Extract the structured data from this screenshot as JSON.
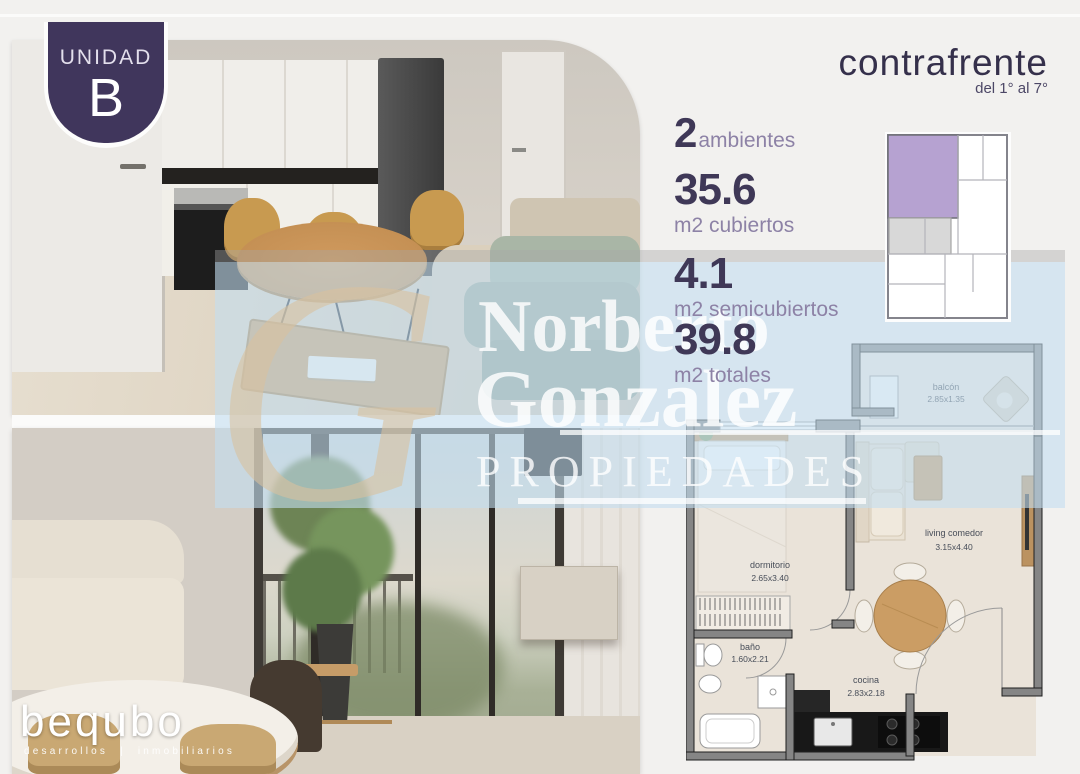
{
  "badge": {
    "line1": "UNIDAD",
    "line2": "B"
  },
  "header": {
    "title": "contrafrente",
    "subtitle": "del 1° al 7°"
  },
  "stats": [
    {
      "value": "2",
      "label": "ambientes"
    },
    {
      "value": "35.6",
      "label": "m2 cubiertos"
    },
    {
      "value": "4.1",
      "label": "m2 semicubiertos"
    },
    {
      "value": "39.8",
      "label": "m2 totales"
    }
  ],
  "floorplan": {
    "rooms": [
      {
        "name": "balcón",
        "dims": "2.85x1.35"
      },
      {
        "name": "dormitorio",
        "dims": "2.65x3.40"
      },
      {
        "name": "living comedor",
        "dims": "3.15x4.40"
      },
      {
        "name": "baño",
        "dims": "1.60x2.21"
      },
      {
        "name": "cocina",
        "dims": "2.83x2.18"
      }
    ]
  },
  "watermark": {
    "monogram": "G",
    "line1": "Norberto",
    "line2": "Gonzalez",
    "line3": "PROPIEDADES"
  },
  "logo": {
    "name": "bequbo",
    "tagline": "desarrollos | inmobiliarios"
  },
  "colors": {
    "accent_purple": "#40365c",
    "number_purple": "#3f3857",
    "label_purple": "#8d82a6",
    "unit_highlight": "#b6a2d1",
    "watermark_blue": "#c3ddf0",
    "watermark_cream": "#d8c29e"
  }
}
